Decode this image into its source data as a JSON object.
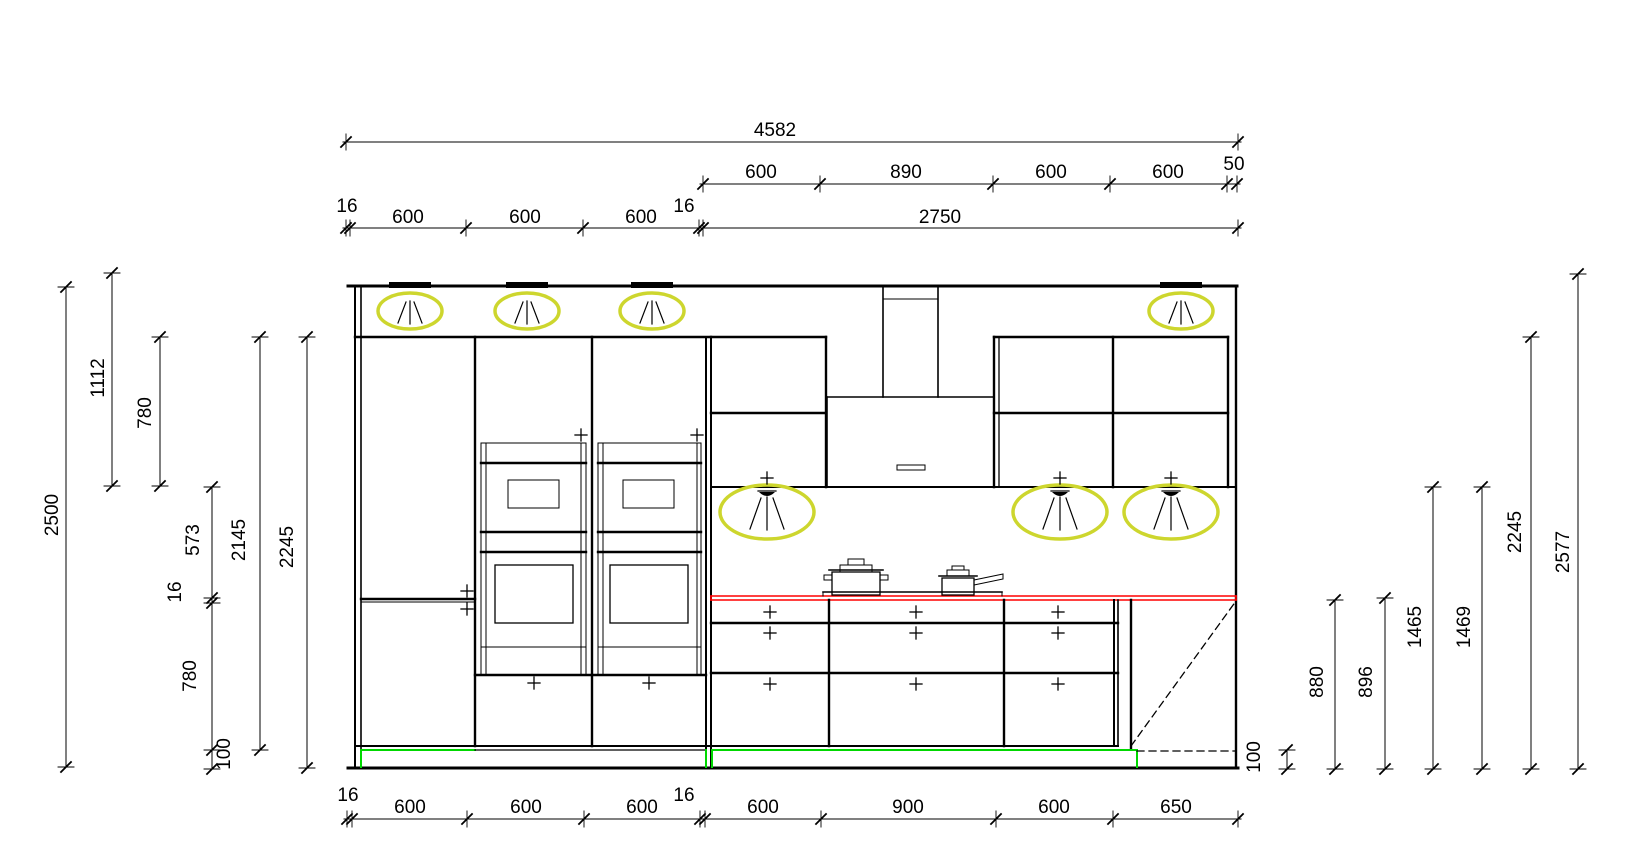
{
  "title": "kitchen elevation drawing",
  "colors": {
    "highlight": "#cdd62e",
    "countertop": "#ff0000",
    "plinth": "#00d800",
    "line": "#000000",
    "background": "#ffffff"
  },
  "icons": {
    "ceiling_light": "downlight-beam-ellipse",
    "wall_light": "downlight-beam-ellipse",
    "handle": "plus-mark"
  },
  "dims": {
    "total": "4582",
    "top2": [
      "600",
      "890",
      "600",
      "600",
      "50"
    ],
    "top3": [
      "16",
      "600",
      "600",
      "600",
      "16",
      "2750"
    ],
    "left": [
      "2500",
      "1112",
      "780",
      "573",
      "16",
      "780",
      "100",
      "2145",
      "2245"
    ],
    "right": [
      "100",
      "880",
      "896",
      "1465",
      "1469",
      "2245",
      "2577"
    ],
    "bottom": [
      "16",
      "600",
      "600",
      "600",
      "16",
      "600",
      "900",
      "600",
      "650"
    ]
  }
}
